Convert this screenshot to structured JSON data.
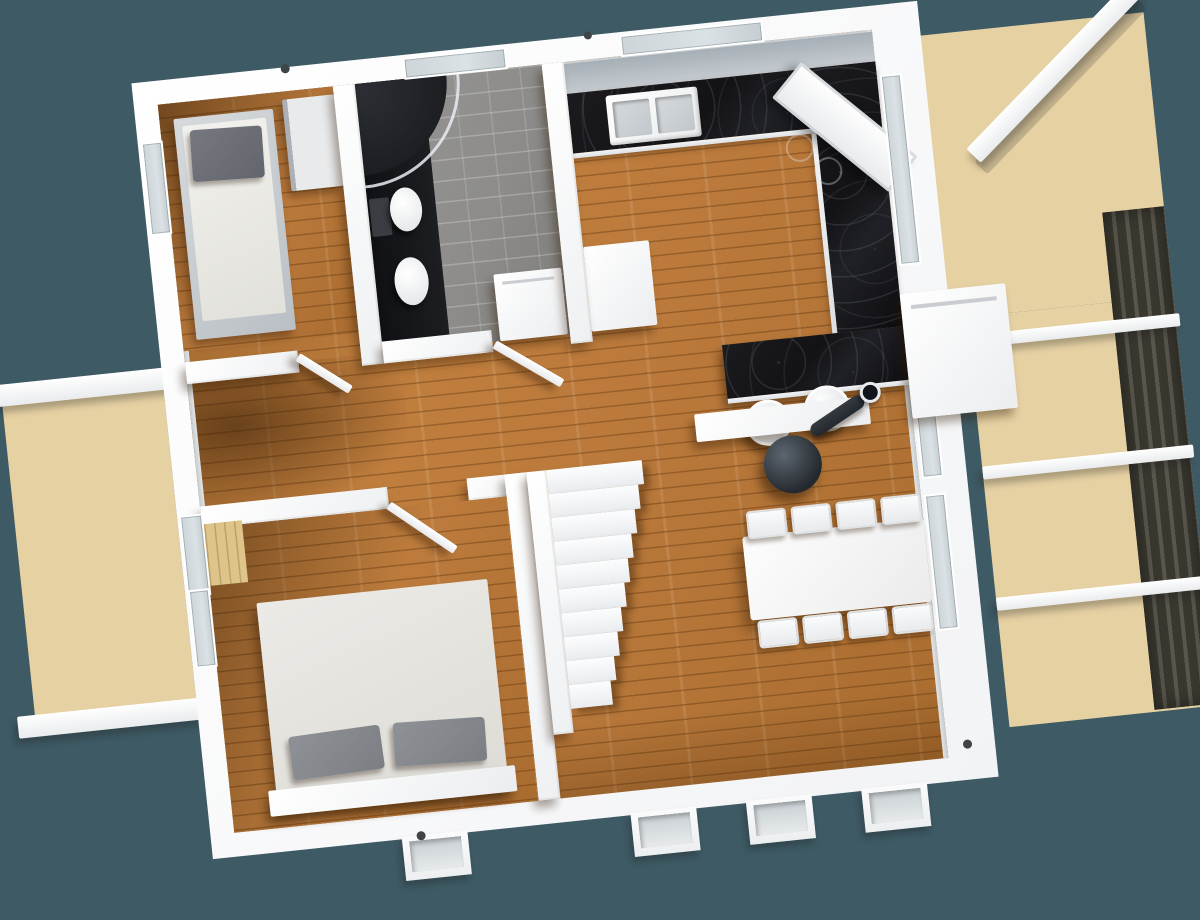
{
  "scene": {
    "type": "3d-floor-plan-render",
    "view": "top-down",
    "rotation_deg": -6,
    "storey": "single-floor-with-staircase"
  },
  "colors": {
    "background": "#3e5a64",
    "wall": "#f5f6f8",
    "wall-shade": "#c9cdd1",
    "floor-wood": "#bb7a3c",
    "floor-wood-light": "#c8853f",
    "floor-shadow": "#3a1f05",
    "tile": "#8d8c8a",
    "dark-fixture": "#17181b",
    "counter": "#131316",
    "deck": "#e6d1a3",
    "deck-line": "#b99a66",
    "glass": "#dbe2e5",
    "stove": "#2b3036",
    "pergola": "#44423c",
    "bed-frame-grey": "#9aa1a8",
    "mattress": "#efeeea",
    "pillow-grey": "#84888d"
  },
  "counts": {
    "stair_steps": 10,
    "dining_chairs_per_side": 4,
    "bar_stools": 2,
    "pergola_crossbars": 3,
    "bottom_facade_windows": 4,
    "interior_doors": 4
  },
  "rooms": [
    {
      "id": "bedroom-upper"
    },
    {
      "id": "bathroom"
    },
    {
      "id": "kitchen"
    },
    {
      "id": "hallway"
    },
    {
      "id": "bedroom-lower"
    },
    {
      "id": "living-dining-room"
    },
    {
      "id": "terrace-left"
    },
    {
      "id": "terrace-upper-right"
    },
    {
      "id": "terrace-right"
    }
  ],
  "furniture": [
    {
      "id": "single-bed"
    },
    {
      "id": "wardrobe"
    },
    {
      "id": "shower-enclosure"
    },
    {
      "id": "toilet"
    },
    {
      "id": "washbasin"
    },
    {
      "id": "washing-machine"
    },
    {
      "id": "u-shaped-kitchen-counter"
    },
    {
      "id": "kitchen-sink"
    },
    {
      "id": "cooktop"
    },
    {
      "id": "extractor-hood"
    },
    {
      "id": "breakfast-bar"
    },
    {
      "id": "bar-stool"
    },
    {
      "id": "kitchen-island-cabinet"
    },
    {
      "id": "staircase"
    },
    {
      "id": "wood-burning-stove"
    },
    {
      "id": "stove-shelf"
    },
    {
      "id": "dining-table"
    },
    {
      "id": "dining-chair"
    },
    {
      "id": "double-bed"
    },
    {
      "id": "floor-to-ceiling-windows"
    },
    {
      "id": "pergola"
    },
    {
      "id": "deck-beams"
    }
  ]
}
